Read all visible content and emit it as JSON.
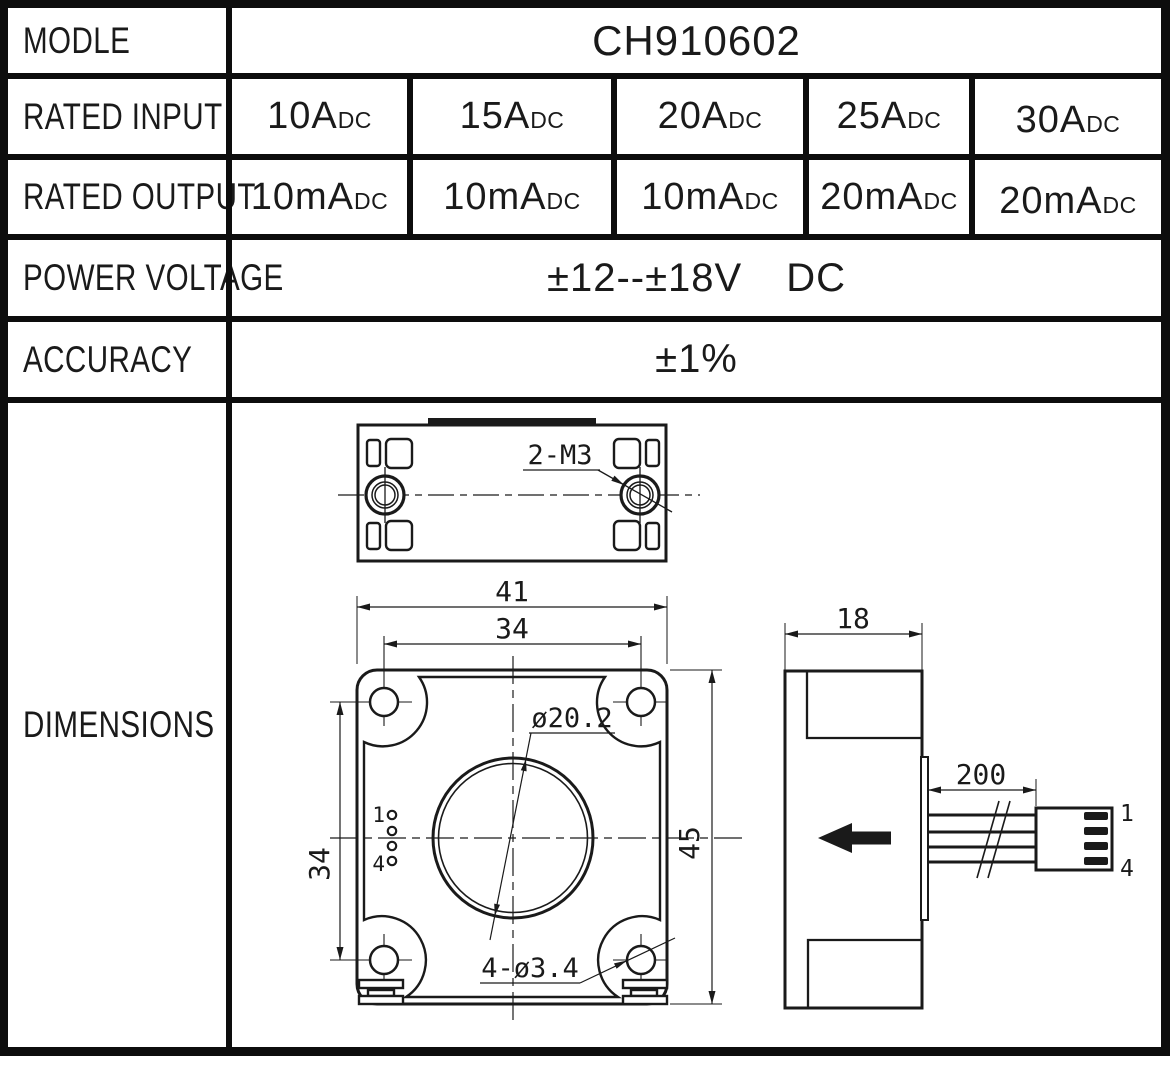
{
  "colors": {
    "ink": "#1a1a1a",
    "paper": "#ffffff"
  },
  "table": {
    "model": {
      "label": "MODLE",
      "value": "CH910602"
    },
    "rated_input": {
      "label": "RATED INPUT",
      "cells": [
        {
          "main": "10A",
          "sub": "DC"
        },
        {
          "main": "15A",
          "sub": "DC"
        },
        {
          "main": "20A",
          "sub": "DC"
        },
        {
          "main": "25A",
          "sub": "DC"
        },
        {
          "main": "30A",
          "sub": "DC"
        }
      ]
    },
    "rated_output": {
      "label": "RATED OUTPUT",
      "cells": [
        {
          "main": "10mA",
          "sub": "DC"
        },
        {
          "main": "10mA",
          "sub": "DC"
        },
        {
          "main": "10mA",
          "sub": "DC"
        },
        {
          "main": "20mA",
          "sub": "DC"
        },
        {
          "main": "20mA",
          "sub": "DC"
        }
      ]
    },
    "power_voltage": {
      "label": "POWER VOLTAGE",
      "value": "±12--±18V",
      "unit": "DC"
    },
    "accuracy": {
      "label": "ACCURACY",
      "value": "±1%"
    },
    "dimensions_label": "DIMENSIONS"
  },
  "drawing": {
    "top_view": {
      "thread_label": "2-M3"
    },
    "front_view": {
      "width": "41",
      "hole_spacing_width": "34",
      "height": "45",
      "hole_spacing_height": "34",
      "aperture_diameter": "ø20.2",
      "mounting_holes": "4-ø3.4",
      "pin_first": "1",
      "pin_last": "4"
    },
    "side_view": {
      "depth": "18",
      "cable_length": "200",
      "pin_first": "1",
      "pin_last": "4"
    }
  }
}
